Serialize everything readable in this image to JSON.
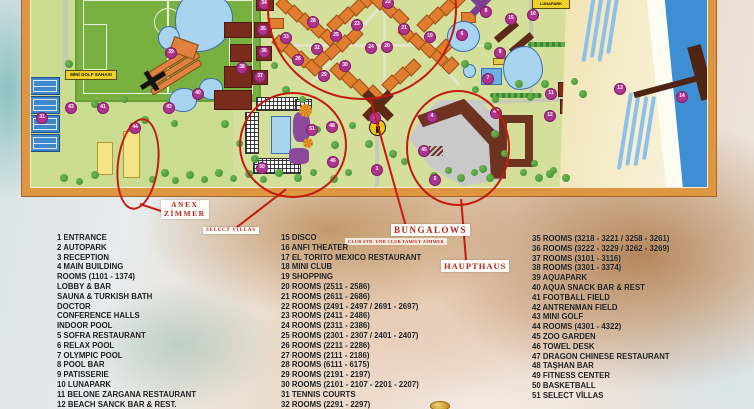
{
  "colors": {
    "annotation_red": "#c41a10",
    "marker_magenta": "#b13390",
    "frame_orange": "#dd9743",
    "grass_green": "#d4e09a",
    "sea_blue": "#3d8ed2",
    "label_yellow": "#f2d12c"
  },
  "map": {
    "labels": {
      "minigolf": "MİNİ GOLF SAHASI",
      "lunapark": "LUNAPARK"
    },
    "annotations": {
      "anex_line1": "ANEX",
      "anex_line2": "ZİMMER",
      "select_villas": "SELECT VILLAS",
      "bungalows": "BUNGALOWS",
      "bungalows_sub": "CLUB STD. UND CLUB FAMILY ZİMMER",
      "haupthaus": "HAUPTHAUS"
    },
    "markers": [
      {
        "n": "31",
        "x": 42,
        "y": 118
      },
      {
        "n": "43",
        "x": 71,
        "y": 108
      },
      {
        "n": "41",
        "x": 103,
        "y": 108
      },
      {
        "n": "44",
        "x": 135,
        "y": 128
      },
      {
        "n": "39",
        "x": 171,
        "y": 53
      },
      {
        "n": "40",
        "x": 198,
        "y": 94
      },
      {
        "n": "42",
        "x": 169,
        "y": 108
      },
      {
        "n": "38",
        "x": 242,
        "y": 68
      },
      {
        "n": "34",
        "x": 264,
        "y": 4
      },
      {
        "n": "35",
        "x": 263,
        "y": 30
      },
      {
        "n": "36",
        "x": 264,
        "y": 52
      },
      {
        "n": "37",
        "x": 260,
        "y": 77
      },
      {
        "n": "28",
        "x": 313,
        "y": 22
      },
      {
        "n": "33",
        "x": 286,
        "y": 38
      },
      {
        "n": "25",
        "x": 336,
        "y": 36
      },
      {
        "n": "22",
        "x": 388,
        "y": 3
      },
      {
        "n": "23",
        "x": 357,
        "y": 25
      },
      {
        "n": "21",
        "x": 404,
        "y": 29
      },
      {
        "n": "24",
        "x": 371,
        "y": 48
      },
      {
        "n": "20",
        "x": 387,
        "y": 47
      },
      {
        "n": "32",
        "x": 317,
        "y": 49
      },
      {
        "n": "26",
        "x": 298,
        "y": 60
      },
      {
        "n": "29",
        "x": 324,
        "y": 76
      },
      {
        "n": "30",
        "x": 345,
        "y": 66
      },
      {
        "n": "19",
        "x": 430,
        "y": 37
      },
      {
        "n": "8",
        "x": 486,
        "y": 12
      },
      {
        "n": "6",
        "x": 462,
        "y": 35
      },
      {
        "n": "7",
        "x": 488,
        "y": 79
      },
      {
        "n": "3",
        "x": 375,
        "y": 118
      },
      {
        "n": "1",
        "x": 377,
        "y": 170
      },
      {
        "n": "51",
        "x": 312,
        "y": 130
      },
      {
        "n": "48",
        "x": 332,
        "y": 127
      },
      {
        "n": "46",
        "x": 333,
        "y": 162
      },
      {
        "n": "50",
        "x": 262,
        "y": 168
      },
      {
        "n": "4",
        "x": 432,
        "y": 117
      },
      {
        "n": "45",
        "x": 424,
        "y": 151
      },
      {
        "n": "5",
        "x": 435,
        "y": 180
      },
      {
        "n": "47",
        "x": 496,
        "y": 113
      },
      {
        "n": "15",
        "x": 511,
        "y": 19
      },
      {
        "n": "10",
        "x": 533,
        "y": 15
      },
      {
        "n": "9",
        "x": 500,
        "y": 53
      },
      {
        "n": "11",
        "x": 551,
        "y": 94
      },
      {
        "n": "12",
        "x": 550,
        "y": 116
      },
      {
        "n": "13",
        "x": 620,
        "y": 89
      },
      {
        "n": "14",
        "x": 682,
        "y": 97
      }
    ]
  },
  "legend": {
    "columns": [
      {
        "items": [
          "1 ENTRANCE",
          "2 AUTOPARK",
          "3 RECEPTION",
          "4 MAIN BUILDING",
          "ROOMS (1101 - 1374)",
          "LOBBY & BAR",
          "SAUNA & TURKISH BATH",
          "DOCTOR",
          "CONFERENCE HALLS",
          "INDOOR POOL",
          "5 SOFRA RESTAURANT",
          "6 RELAX POOL",
          "7 OLYMPIC POOL",
          "8 POOL BAR",
          "9 PATISSERIE",
          "10 LUNAPARK",
          "11 BELONE ZARGANA RESTAURANT",
          "12 BEACH SANCK BAR & REST."
        ]
      },
      {
        "items": [
          "15 DISCO",
          "16 ANFI THEATER",
          "17 EL TORITO MEXICO RESTAURANT",
          "18 MINI CLUB",
          "19 SHOPPING",
          "20 ROOMS (2511 - 2586)",
          "21 ROOMS (2611 - 2686)",
          "22 ROOMS (2491 - 2497 / 2691 - 2697)",
          "23 ROOMS (2411 - 2486)",
          "24 ROOMS (2311 - 2386)",
          "25 ROOMS (2301 - 2307 / 2401 - 2407)",
          "26 ROOMS (2211 - 2286)",
          "27 ROOMS (2111 - 2186)",
          "28 ROOMS (6111 - 6175)",
          "29 ROOMS (2191 - 2197)",
          "30 ROOMS (2101 - 2107 - 2201 - 2207)",
          "31 TENNIS COURTS",
          "32 ROOMS (2291 - 2297)"
        ]
      },
      {
        "items": [
          "35 ROOMS (3218 - 3221 / 3258 - 3261)",
          "36 ROOMS (3222 - 3229 / 3262 - 3269)",
          "37 ROOMS (3101 - 3116)",
          "38 ROOMS (3301 - 3374)",
          "39 AQUAPARK",
          "40 AQUA SNACK BAR & REST",
          "41 FOOTBALL FIELD",
          "42 ANTRENMAN FIELD",
          "43 MINI GOLF",
          "44 ROOMS (4301 - 4322)",
          "45 ZOO GARDEN",
          "46 TOWEL DESK",
          "47 DRAGON CHINESE RESTAURANT",
          "48 TAŞHAN BAR",
          "49 FITNESS CENTER",
          "50 BASKETBALL",
          "51 SELECT VİLLAS"
        ]
      }
    ]
  }
}
